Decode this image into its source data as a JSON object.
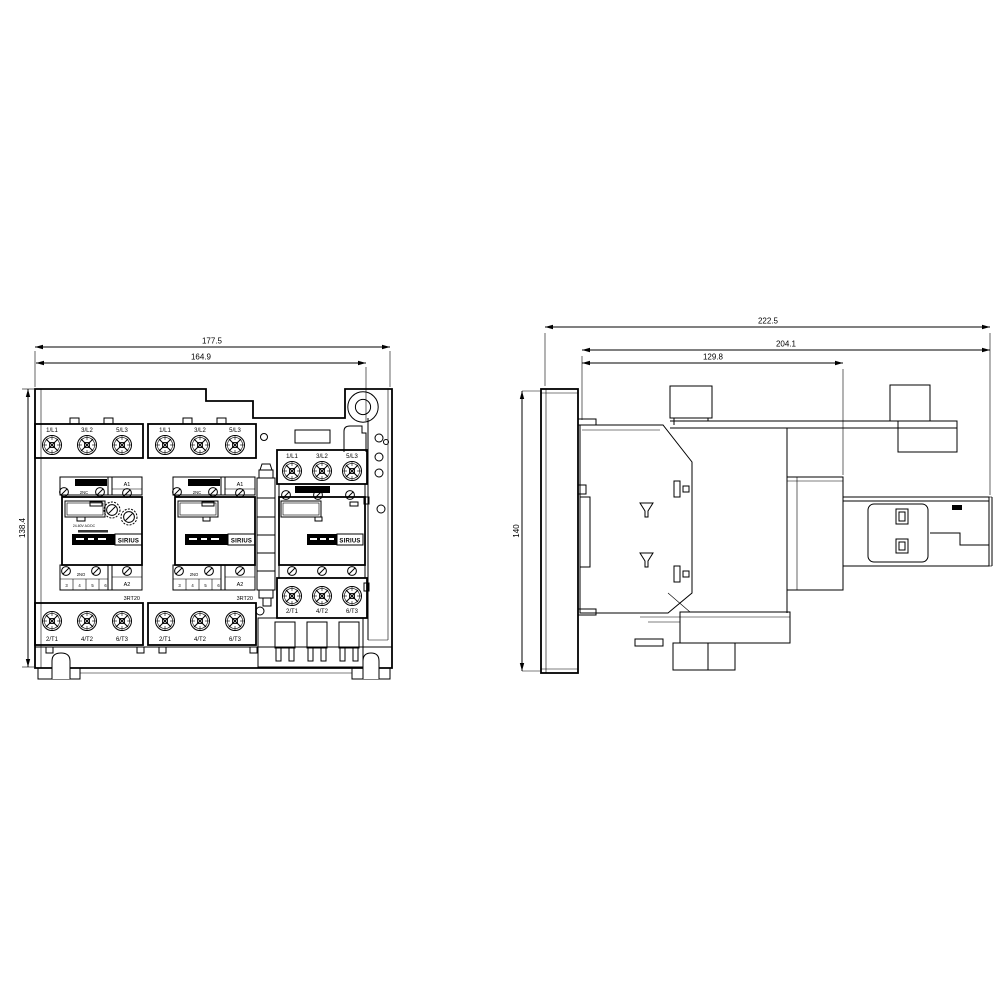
{
  "front_view": {
    "dimensions": {
      "total_width": "177.5",
      "width_to_hole": "164.9",
      "height": "138.4"
    },
    "contactors": [
      {
        "top_terminals": [
          "1/L1",
          "3/L2",
          "5/L3"
        ],
        "bottom_terminals": [
          "2/T1",
          "4/T2",
          "6/T3"
        ],
        "coil_top": "A1",
        "coil_bottom": "A2",
        "aux_top": "2NC",
        "aux_bottom": "2NO",
        "aux_terms": [
          "3",
          "4",
          "5",
          "6"
        ],
        "brand": "SIRIUS",
        "type_label": "3RT20",
        "voltage_label": "24-60V AC/DC"
      },
      {
        "top_terminals": [
          "1/L1",
          "3/L2",
          "5/L3"
        ],
        "bottom_terminals": [
          "2/T1",
          "4/T2",
          "6/T3"
        ],
        "coil_top": "A1",
        "coil_bottom": "A2",
        "aux_top": "2NC",
        "aux_bottom": "2NO",
        "aux_terms": [
          "3",
          "4",
          "5",
          "6"
        ],
        "brand": "SIRIUS",
        "type_label": "3RT20"
      },
      {
        "top_terminals": [
          "1/L1",
          "3/L2",
          "5/L3"
        ],
        "bottom_terminals": [
          "2/T1",
          "4/T2",
          "6/T3"
        ],
        "brand": "SIRIUS"
      }
    ]
  },
  "side_view": {
    "dimensions": {
      "total_depth": "222.5",
      "depth_without_plate": "204.1",
      "body_depth": "129.8",
      "height": "140"
    }
  }
}
